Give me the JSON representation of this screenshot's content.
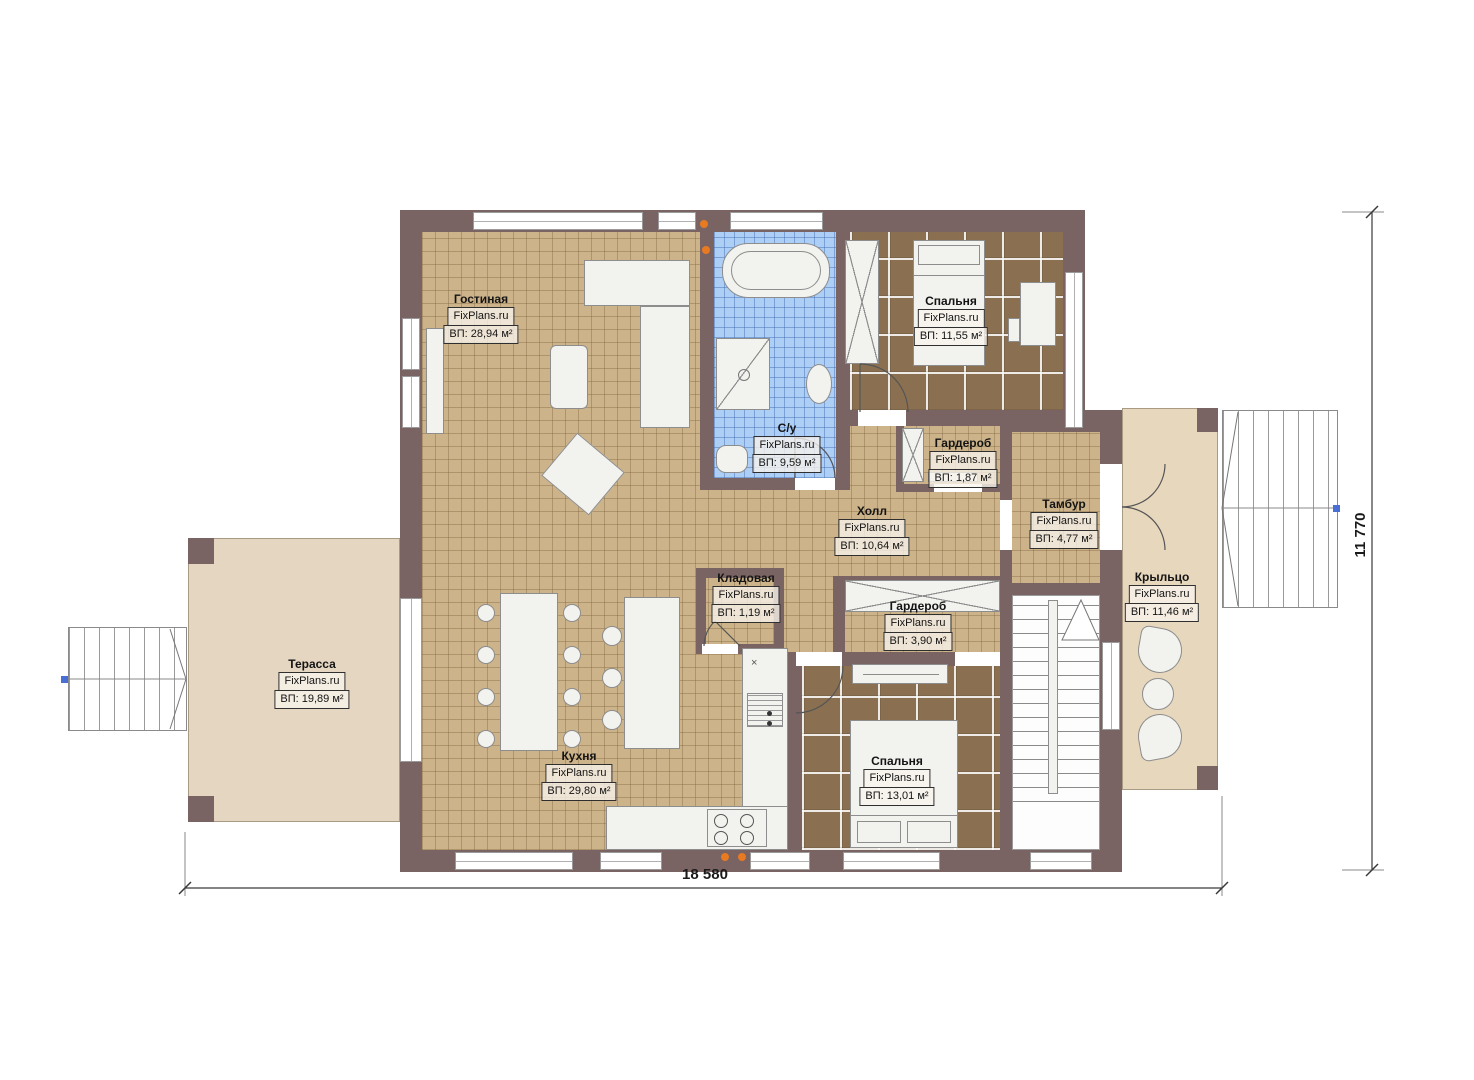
{
  "dimensions": {
    "width_label": "18 580",
    "height_label": "11 770"
  },
  "rooms": [
    {
      "id": "living",
      "name": "Гостиная",
      "brand": "FixPlans.ru",
      "area": "ВП: 28,94 м²"
    },
    {
      "id": "bedroom1",
      "name": "Спальня",
      "brand": "FixPlans.ru",
      "area": "ВП: 11,55 м²"
    },
    {
      "id": "bathroom",
      "name": "С/у",
      "brand": "FixPlans.ru",
      "area": "ВП: 9,59 м²"
    },
    {
      "id": "wardrobe1",
      "name": "Гардероб",
      "brand": "FixPlans.ru",
      "area": "ВП: 1,87 м²"
    },
    {
      "id": "tambour",
      "name": "Тамбур",
      "brand": "FixPlans.ru",
      "area": "ВП: 4,77 м²"
    },
    {
      "id": "hall",
      "name": "Холл",
      "brand": "FixPlans.ru",
      "area": "ВП: 10,64 м²"
    },
    {
      "id": "pantry",
      "name": "Кладовая",
      "brand": "FixPlans.ru",
      "area": "ВП: 1,19 м²"
    },
    {
      "id": "wardrobe2",
      "name": "Гардероб",
      "brand": "FixPlans.ru",
      "area": "ВП: 3,90 м²"
    },
    {
      "id": "porch",
      "name": "Крыльцо",
      "brand": "FixPlans.ru",
      "area": "ВП: 11,46 м²"
    },
    {
      "id": "terrace",
      "name": "Терасса",
      "brand": "FixPlans.ru",
      "area": "ВП: 19,89 м²"
    },
    {
      "id": "kitchen",
      "name": "Кухня",
      "brand": "FixPlans.ru",
      "area": "ВП: 29,80 м²"
    },
    {
      "id": "bedroom2",
      "name": "Спальня",
      "brand": "FixPlans.ru",
      "area": "ВП: 13,01 м²"
    }
  ],
  "colors": {
    "wall": "#7a6363",
    "tile": "#ccb38a",
    "bath": "#adcef5",
    "carpet": "#8a7050",
    "terrace": "#e4d6c1",
    "porch": "#e7d7bd",
    "accent": "#e87a22",
    "marker": "#4a6fd4"
  }
}
